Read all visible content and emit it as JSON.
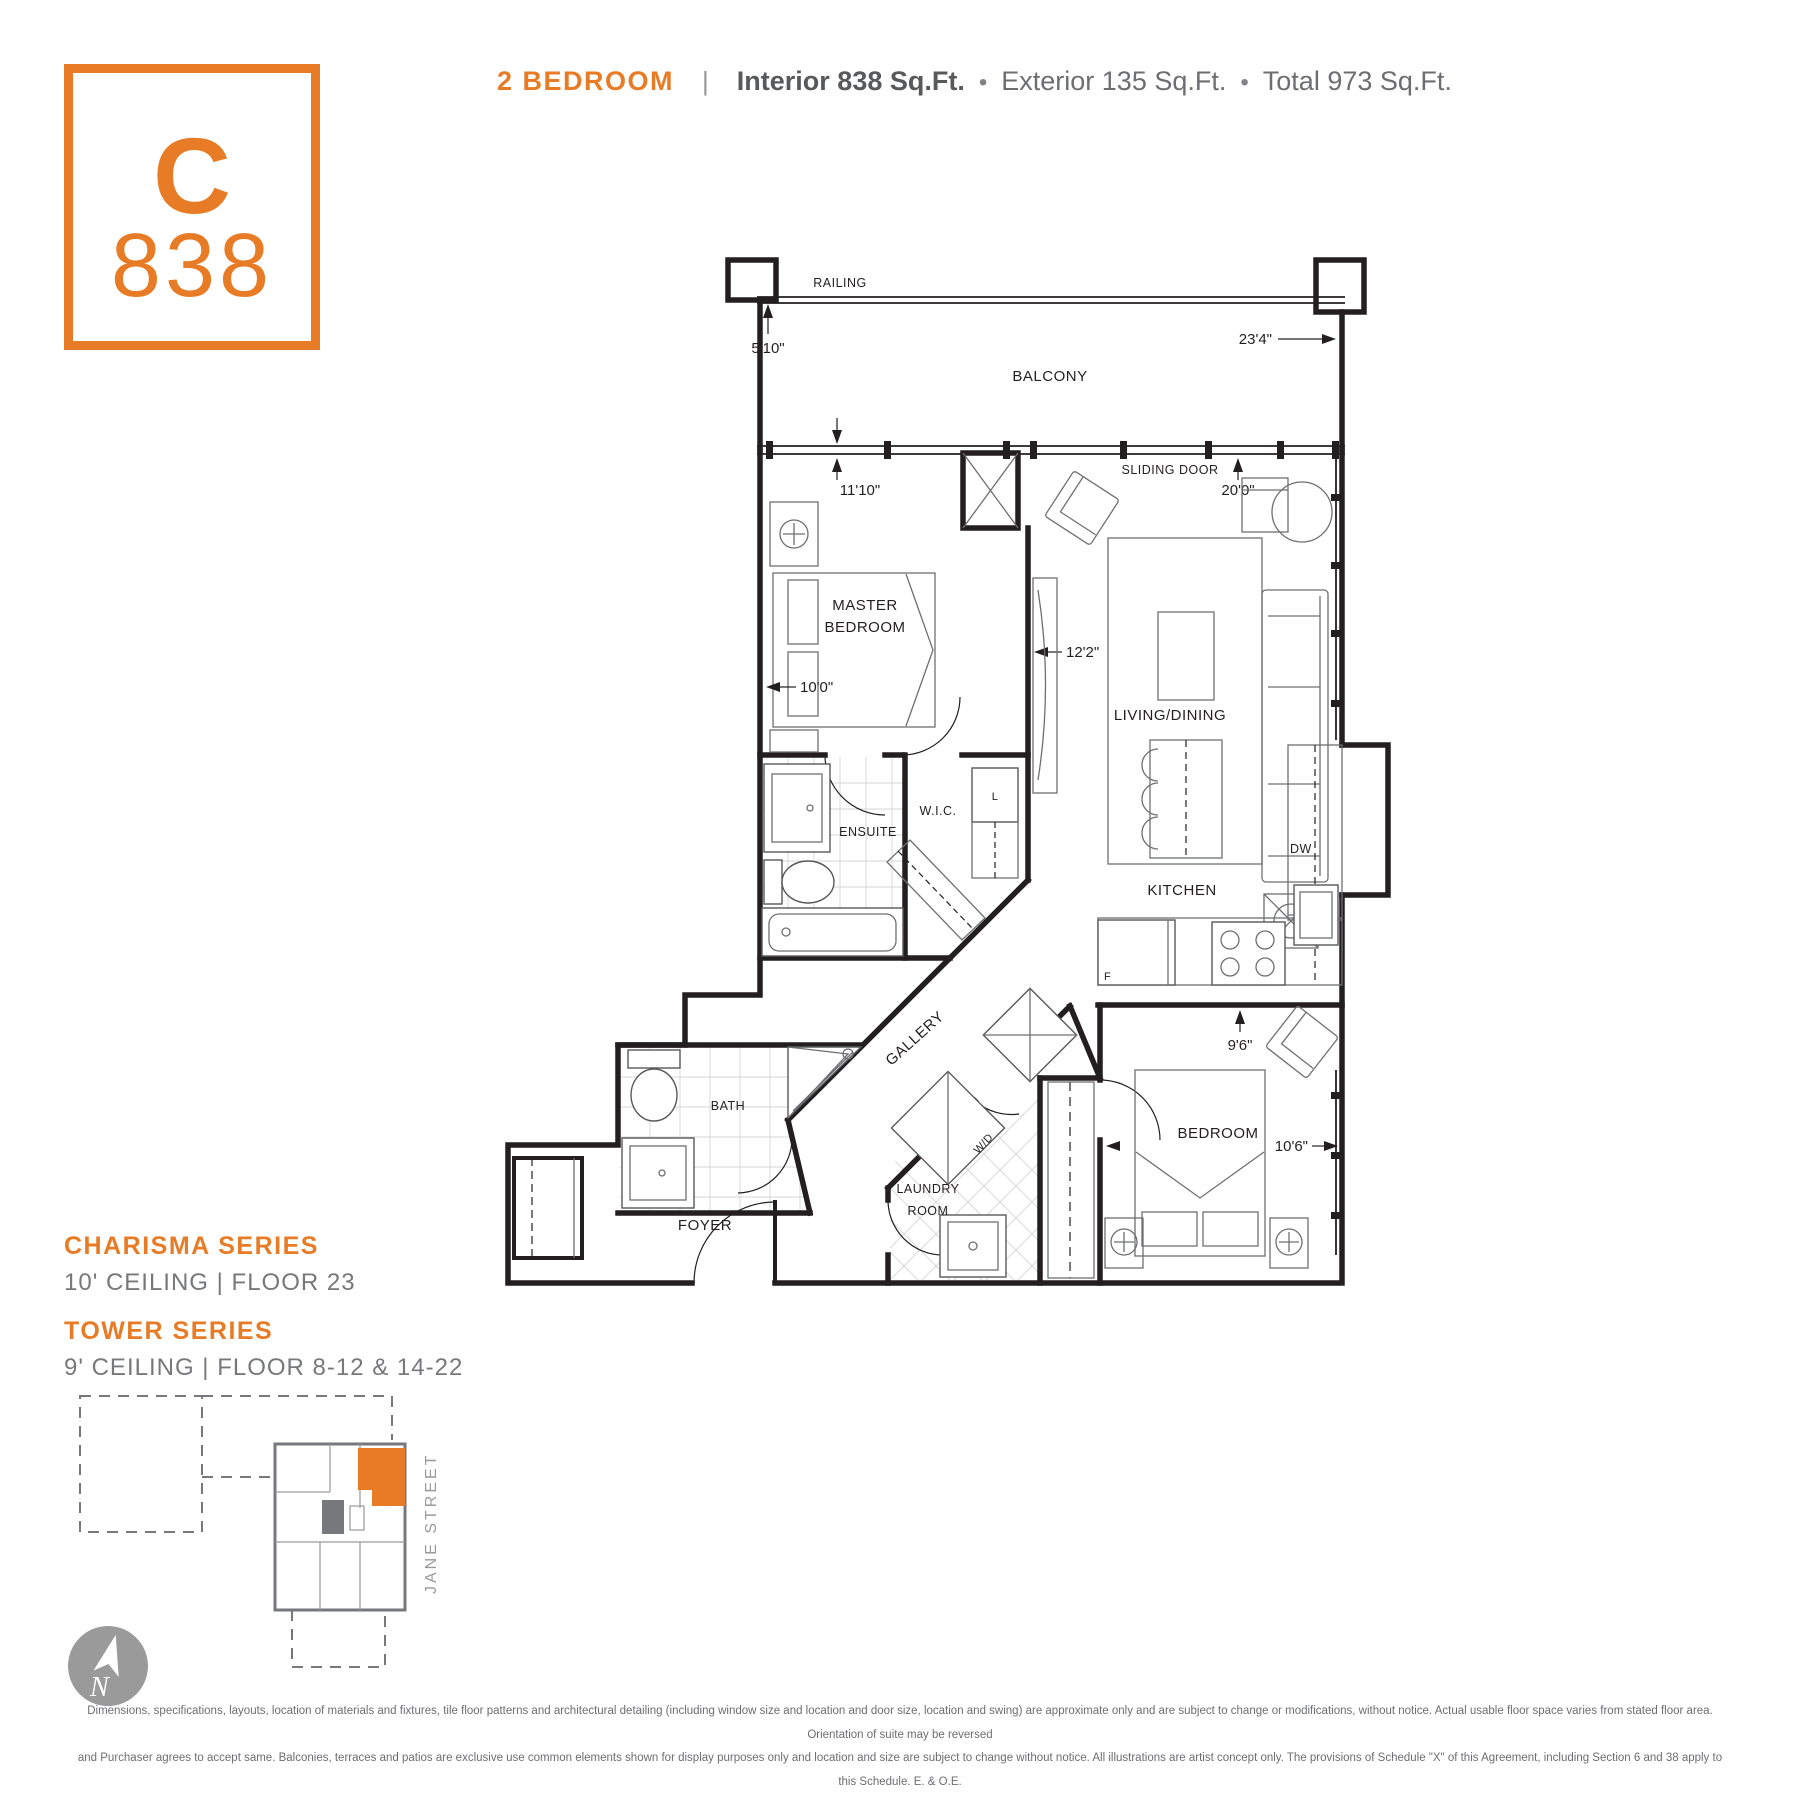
{
  "badge": {
    "letter": "C",
    "number": "838"
  },
  "header": {
    "type": "2 BEDROOM",
    "separator": "|",
    "interior": "Interior 838 Sq.Ft.",
    "bullet": "•",
    "exterior": "Exterior 135 Sq.Ft.",
    "total": "Total 973 Sq.Ft."
  },
  "series": {
    "charisma_title": "CHARISMA SERIES",
    "charisma_info": "10' CEILING  |  FLOOR 23",
    "tower_title": "TOWER SERIES",
    "tower_info": "9' CEILING  |  FLOOR 8-12 & 14-22"
  },
  "floorplan": {
    "rooms": {
      "balcony": "BALCONY",
      "master_line1": "MASTER",
      "master_line2": "BEDROOM",
      "living_dining": "LIVING/DINING",
      "kitchen": "KITCHEN",
      "ensuite": "ENSUITE",
      "wic": "W.I.C.",
      "bath": "BATH",
      "gallery": "GALLERY",
      "foyer": "FOYER",
      "laundry_line1": "LAUNDRY",
      "laundry_line2": "ROOM",
      "bedroom": "BEDROOM"
    },
    "labels": {
      "railing": "RAILING",
      "sliding_door": "SLIDING DOOR",
      "dishwasher": "DW",
      "washer_dryer": "W/D",
      "fridge": "F",
      "linen": "L"
    },
    "dimensions": {
      "balcony_depth": "5'10\"",
      "balcony_width": "23'4\"",
      "master_width": "11'10\"",
      "master_depth": "10'0\"",
      "living_width": "20'0\"",
      "living_depth": "12'2\"",
      "bedroom_width": "9'6\"",
      "bedroom_depth": "10'6\""
    }
  },
  "keyplan": {
    "street": "JANE STREET",
    "compass": "N",
    "highlight_color": "#E87C26"
  },
  "disclaimer": {
    "line1": "Dimensions, specifications, layouts, location of materials and fixtures, tile floor patterns and architectural detailing (including window size and location and door size, location and swing) are approximate only and are subject to change or modifications, without notice. Actual usable floor space varies from stated floor area. Orientation of suite may be reversed",
    "line2": "and Purchaser agrees to accept same. Balconies, terraces and patios are exclusive use common elements shown for display purposes only and location and size are subject to change without notice. All illustrations are artist concept only. The provisions of Schedule \"X\" of this Agreement, including Section 6 and 38 apply to this Schedule. E. & O.E."
  },
  "colors": {
    "orange": "#E87C26",
    "dark_text": "#58595b",
    "gray_text": "#6d6e71",
    "plan_line": "#231f20",
    "keyplan_gray": "#77787b"
  }
}
